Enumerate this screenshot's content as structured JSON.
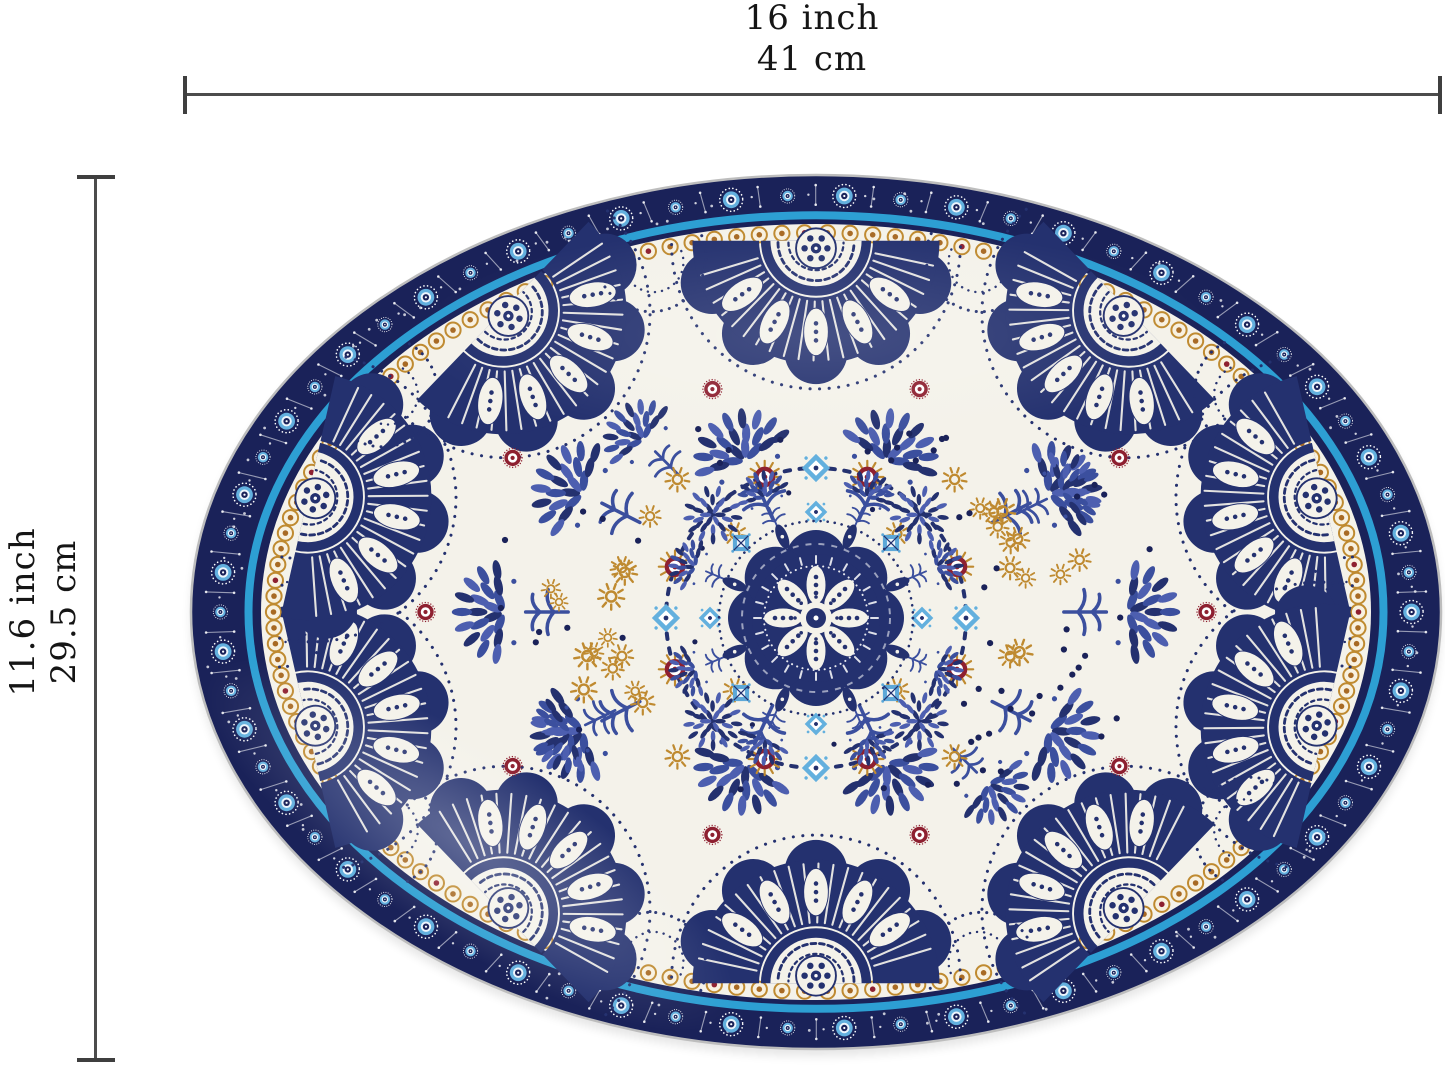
{
  "dimensions": {
    "width": {
      "inches": "16 inch",
      "cm": "41 cm"
    },
    "height": {
      "inches": "11.6 inch",
      "cm": "29.5 cm"
    }
  },
  "palette": {
    "navy": "#24316f",
    "navy_deep": "#1a2259",
    "blue_mid": "#3b4f9e",
    "blue_leaf": "#4d5fb0",
    "blue_light": "#63b0de",
    "blue_pale": "#a9d2ec",
    "teal": "#2d9fd3",
    "ochre": "#bf8a30",
    "ochre_deep": "#a86a24",
    "maroon": "#8e2030",
    "cream": "#f4f2ea",
    "dimension_line": "#4c4c4c",
    "text": "#151515",
    "background": "#ffffff"
  }
}
